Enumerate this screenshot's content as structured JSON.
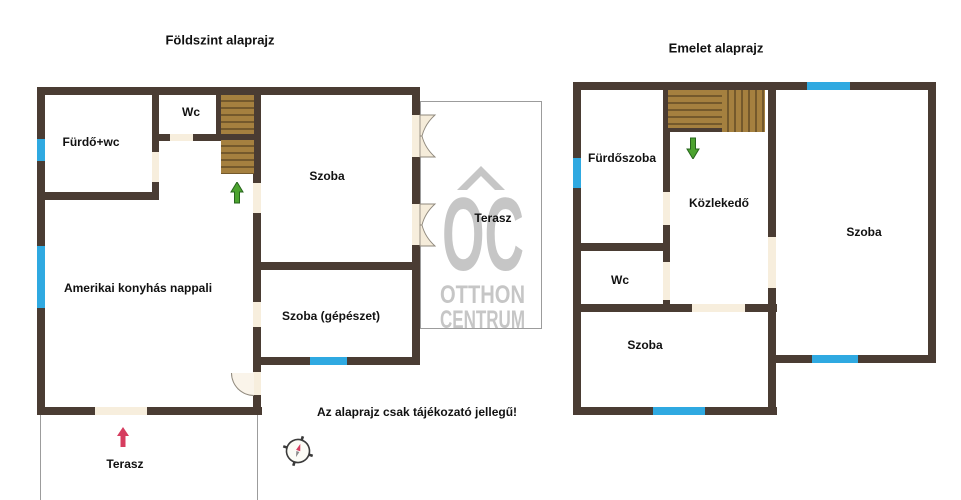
{
  "ground_floor": {
    "title": "Földszint alaprajz",
    "rooms": {
      "bathroom": "Fürdő+wc",
      "wc": "Wc",
      "bedroom": "Szoba",
      "living_room": "Amerikai konyhás nappali",
      "mechanical_room": "Szoba (gépészet)",
      "terrace_side": "Terasz",
      "terrace_front": "Terasz"
    }
  },
  "upper_floor": {
    "title": "Emelet alaprajz",
    "rooms": {
      "bathroom": "Fürdőszoba",
      "hallway": "Közlekedő",
      "bedroom_right": "Szoba",
      "wc": "Wc",
      "bedroom_left": "Szoba"
    }
  },
  "watermark": {
    "monogram": "OC",
    "name_line1": "OTTHON",
    "name_line2": "CENTRUM"
  },
  "disclaimer": "Az alaprajz csak tájékozató jellegű!",
  "colors": {
    "wall": "#4a3c33",
    "window": "#2fa9e1",
    "stair": "#a5803f",
    "stair_stripe": "#74592c",
    "door_opening": "#f7eedd",
    "watermark": "#c6c6c6",
    "arrow_green": "#4ca32f",
    "arrow_red": "#d63d5f",
    "text": "#111111"
  }
}
